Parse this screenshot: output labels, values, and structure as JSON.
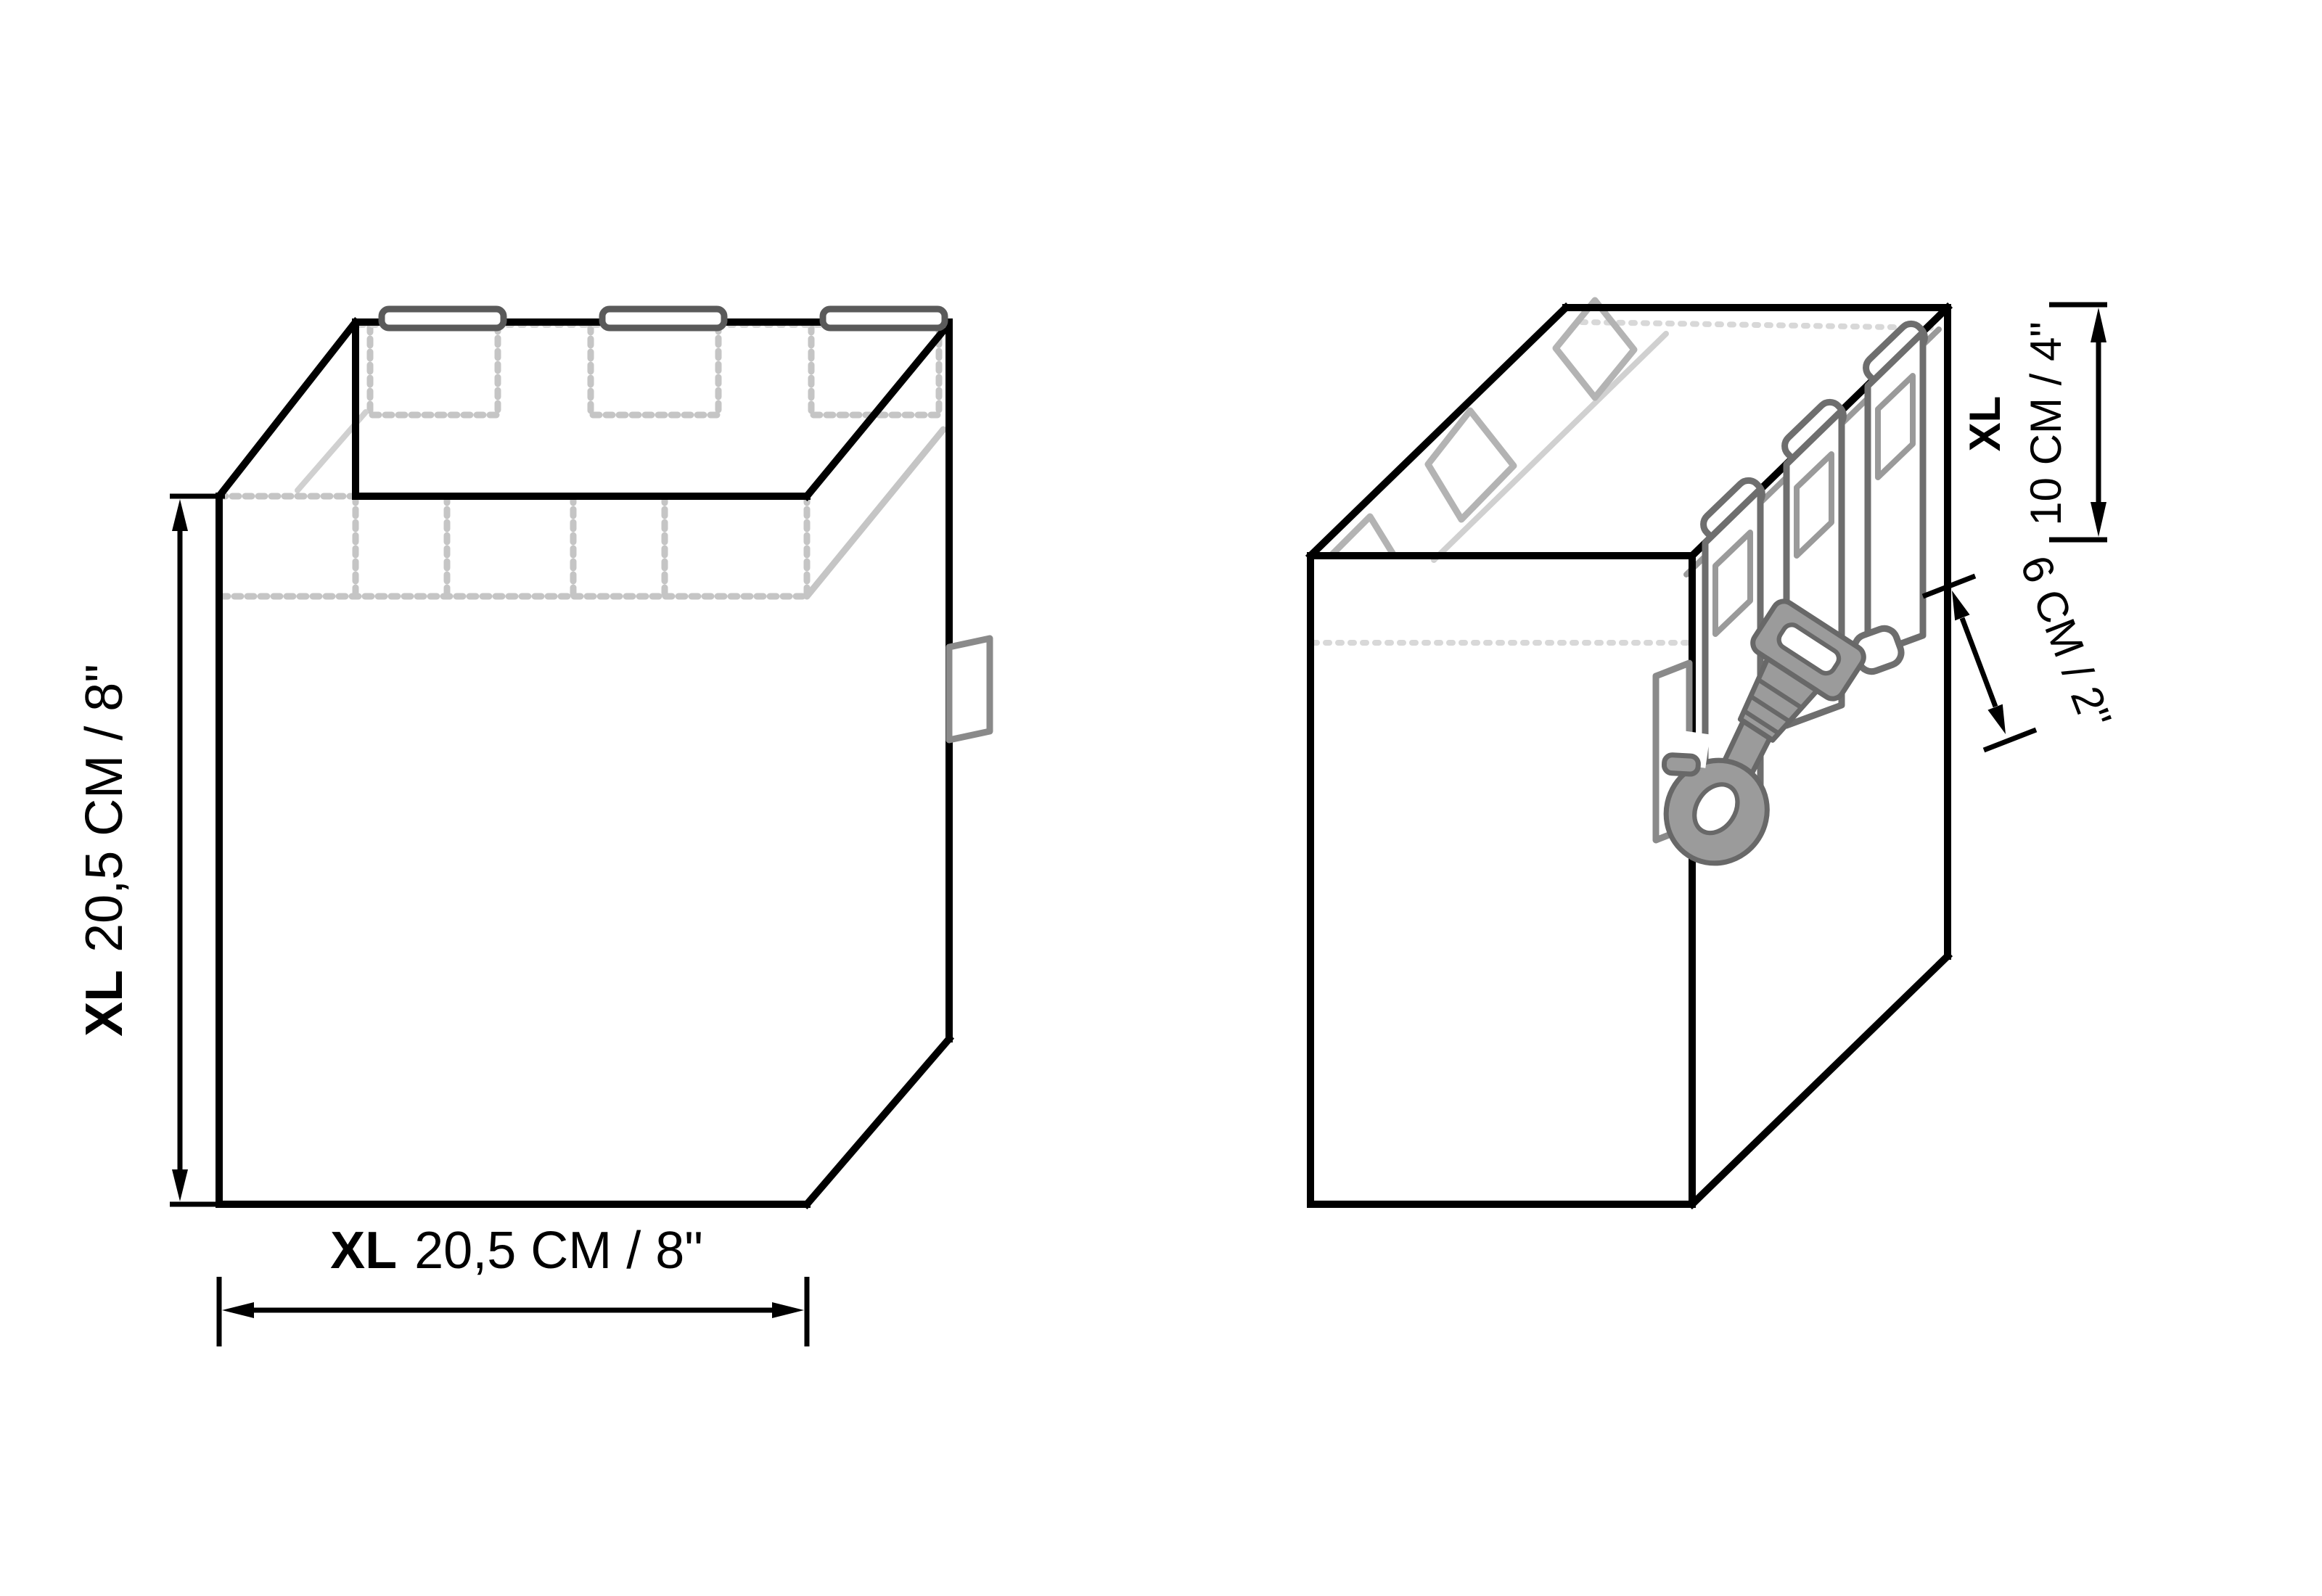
{
  "drawing": {
    "title": "pouch-dimension-diagram",
    "background": "#ffffff",
    "size_code": "XL",
    "front_view": {
      "height_label": {
        "size": "XL",
        "text": "20,5 CM / 8\""
      },
      "width_label": {
        "size": "XL",
        "text": "20,5 CM / 8\""
      },
      "molle_cells": 5,
      "inner_velcro_patches": 3,
      "top_tabs": 3
    },
    "side_view": {
      "depth_label": {
        "size": "XL",
        "text": "10 CM / 4\""
      },
      "strap_label": {
        "text": "6 CM / 2\""
      },
      "molle_straps": 3,
      "inner_velcro_patches": 3
    },
    "colors": {
      "outline": "#000000",
      "stitch_light_gray": "#c5c5c5",
      "mid_gray": "#9a9a9a",
      "strap_dark_gray": "#6e6e6e",
      "clip_fill": "#9b9b9b"
    }
  }
}
